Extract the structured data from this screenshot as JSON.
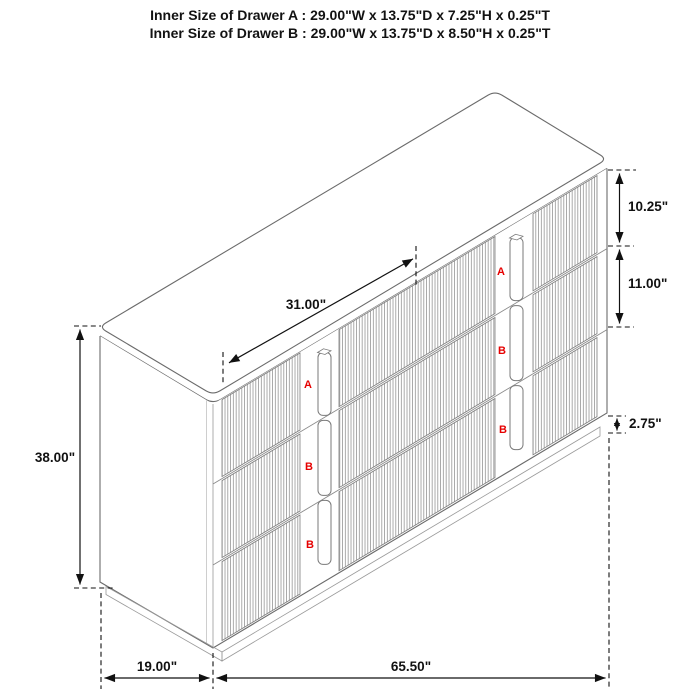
{
  "header": {
    "line1": "Inner Size of Drawer A : 29.00\"W x 13.75\"D x 7.25\"H x 0.25\"T",
    "line2": "Inner Size of Drawer B : 29.00\"W x 13.75\"D x 8.50\"H x 0.25\"T"
  },
  "dimensions": {
    "top_diagonal_width": "31.00\"",
    "drawer_a_front_height": "10.25\"",
    "drawer_b_front_height": "11.00\"",
    "base_height": "2.75\"",
    "overall_height": "38.00\"",
    "depth": "19.00\"",
    "overall_width": "65.50\""
  },
  "drawer_labels": {
    "left_stack": [
      "A",
      "B",
      "B"
    ],
    "right_stack": [
      "A",
      "B",
      "B"
    ]
  },
  "colors": {
    "outline": "#6b6b6b",
    "flute": "#8f8f8f",
    "dimension": "#111111",
    "drawer_label": "#e60000",
    "background": "#ffffff"
  }
}
